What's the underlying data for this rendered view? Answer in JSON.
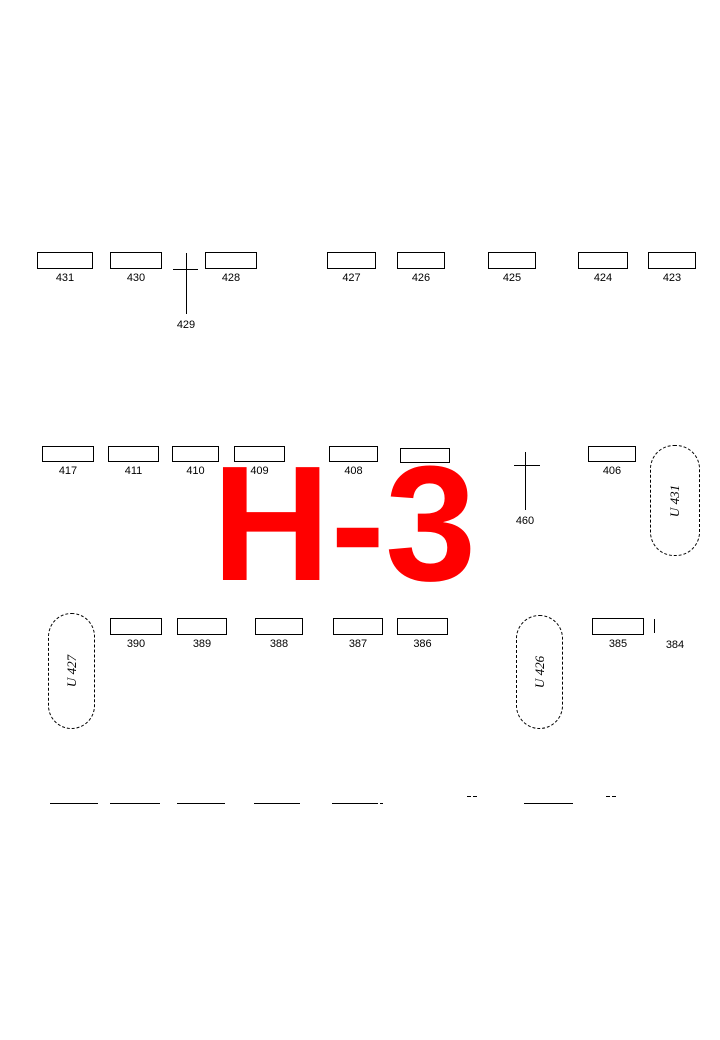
{
  "canvas": {
    "width": 720,
    "height": 1040,
    "background": "#ffffff",
    "line_color": "#000000"
  },
  "section": {
    "label": "H-3",
    "color": "#ff0000"
  },
  "graves": [
    {
      "label": "431",
      "x": 37,
      "y": 252,
      "w": 56,
      "h": 17
    },
    {
      "label": "430",
      "x": 110,
      "y": 252,
      "w": 52,
      "h": 17
    },
    {
      "label": "428",
      "x": 205,
      "y": 252,
      "w": 52,
      "h": 17
    },
    {
      "label": "427",
      "x": 327,
      "y": 252,
      "w": 49,
      "h": 17
    },
    {
      "label": "426",
      "x": 397,
      "y": 252,
      "w": 48,
      "h": 17
    },
    {
      "label": "425",
      "x": 488,
      "y": 252,
      "w": 48,
      "h": 17
    },
    {
      "label": "424",
      "x": 578,
      "y": 252,
      "w": 50,
      "h": 17
    },
    {
      "label": "423",
      "x": 648,
      "y": 252,
      "w": 48,
      "h": 17
    },
    {
      "label": "417",
      "x": 42,
      "y": 446,
      "w": 52,
      "h": 16
    },
    {
      "label": "411",
      "x": 108,
      "y": 446,
      "w": 51,
      "h": 16
    },
    {
      "label": "410",
      "x": 172,
      "y": 446,
      "w": 47,
      "h": 16
    },
    {
      "label": "409",
      "x": 234,
      "y": 446,
      "w": 51,
      "h": 16
    },
    {
      "label": "408",
      "x": 329,
      "y": 446,
      "w": 49,
      "h": 16
    },
    {
      "label": "",
      "x": 400,
      "y": 448,
      "w": 50,
      "h": 15
    },
    {
      "label": "406",
      "x": 588,
      "y": 446,
      "w": 48,
      "h": 16
    },
    {
      "label": "390",
      "x": 110,
      "y": 618,
      "w": 52,
      "h": 17
    },
    {
      "label": "389",
      "x": 177,
      "y": 618,
      "w": 50,
      "h": 17
    },
    {
      "label": "388",
      "x": 255,
      "y": 618,
      "w": 48,
      "h": 17
    },
    {
      "label": "387",
      "x": 333,
      "y": 618,
      "w": 50,
      "h": 17
    },
    {
      "label": "386",
      "x": 397,
      "y": 618,
      "w": 51,
      "h": 17
    },
    {
      "label": "385",
      "x": 592,
      "y": 618,
      "w": 52,
      "h": 17
    }
  ],
  "crosses": [
    {
      "label": "429",
      "cx": 186,
      "top": 253,
      "bottom": 314,
      "bar_y": 269,
      "bar_x1": 173,
      "bar_x2": 198,
      "label_y": 319
    },
    {
      "label": "460",
      "cx": 525,
      "top": 452,
      "bottom": 510,
      "bar_y": 465,
      "bar_x1": 514,
      "bar_x2": 540,
      "label_y": 515
    }
  ],
  "urn_plots": [
    {
      "label": "U 431",
      "x": 650,
      "y": 445,
      "w": 50,
      "h": 111
    },
    {
      "label": "U 427",
      "x": 48,
      "y": 613,
      "w": 47,
      "h": 116
    },
    {
      "label": "U 426",
      "x": 516,
      "y": 615,
      "w": 47,
      "h": 114
    }
  ],
  "edge_ticks": [
    {
      "label": "384",
      "x": 654,
      "y": 619,
      "h": 14,
      "label_cx": 675,
      "label_y": 639
    }
  ],
  "partial_lines": [
    {
      "x": 50,
      "y": 803,
      "w": 48
    },
    {
      "x": 110,
      "y": 803,
      "w": 50
    },
    {
      "x": 177,
      "y": 803,
      "w": 48
    },
    {
      "x": 254,
      "y": 803,
      "w": 46
    },
    {
      "x": 332,
      "y": 803,
      "w": 46
    },
    {
      "x": 380,
      "y": 803,
      "w": 3
    },
    {
      "x": 524,
      "y": 803,
      "w": 49
    },
    {
      "x": 467,
      "y": 796,
      "w": 4
    },
    {
      "x": 473,
      "y": 796,
      "w": 4
    },
    {
      "x": 606,
      "y": 796,
      "w": 4
    },
    {
      "x": 612,
      "y": 796,
      "w": 4
    }
  ]
}
